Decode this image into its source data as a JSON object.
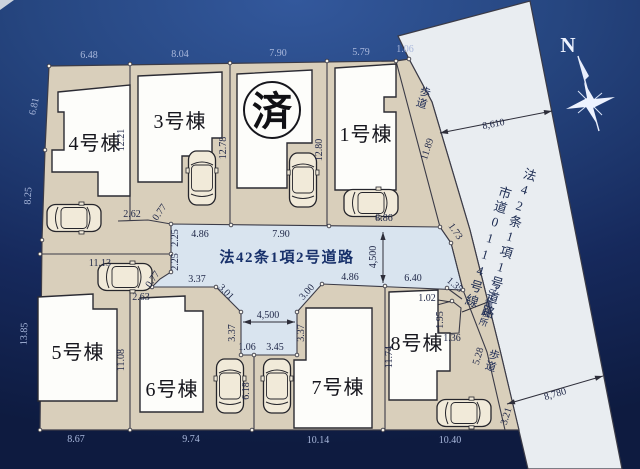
{
  "site_plan": {
    "lots": {
      "lot1": "1号棟",
      "lot3": "3号棟",
      "lot4": "4号棟",
      "lot5": "5号棟",
      "lot6": "6号棟",
      "lot7": "7号棟",
      "lot8": "8号棟",
      "lot2_sold_mark": "済"
    },
    "roads": {
      "middle_road": "法42条1項2号道路",
      "right_road_law": "法42条1項1号道路",
      "right_road_name": "市道0114号線"
    },
    "labels": {
      "sidewalk_upper": "歩道",
      "sidewalk_lower": "歩道",
      "garbage_station": "ゴミ集積所",
      "compass_north": "N"
    },
    "dims": {
      "top_lot4": "6.48",
      "top_lot3": "8.04",
      "top_lot2": "7.90",
      "top_lot1": "5.79",
      "top_corner": "1.06",
      "left_upper": "6.81",
      "left_middle": "8.25",
      "left_lower": "13.85",
      "bottom_lot5": "8.67",
      "bottom_lot6": "9.74",
      "bottom_lot7": "10.14",
      "bottom_lot8": "10.40",
      "b_lot4_lot3": "12.21",
      "b_lot3_lot2": "12.78",
      "b_lot2_lot1": "12.80",
      "b_lot5_lot6": "11.08",
      "b_lot7_lot8": "11.74",
      "lot5_north": "11.13",
      "lot67_parking": "6.18",
      "road_top_w": "4.86",
      "road_top_e": "7.90",
      "lot1_south": "8.86",
      "lot1_se_diag": "1.73",
      "road_e_width": "4,500",
      "step_a": "2.62",
      "step_b": "0.77",
      "step_c": "2.25",
      "step_d": "2.25",
      "step_e": "0.77",
      "step_f": "2.63",
      "lot6_north": "3.37",
      "stub_diag_w": "3.01",
      "stub_diag_e": "3.00",
      "stub_w": "3.37",
      "stub_e": "3.37",
      "stub_width": "4,500",
      "stub_s_w": "1.06",
      "stub_s_e": "3.45",
      "lot7_north": "4.86",
      "lot8_north": "6.40",
      "c8_diag": "1.35",
      "gb_n": "1.02",
      "gb_w": "1.95",
      "gb_s": "1.36",
      "sw_lot1": "11.89",
      "sw_lot8": "5.28",
      "sw_end": "3.21",
      "road_w_n": "8,610",
      "road_w_s": "8,780"
    },
    "colors": {
      "background_navy": "#16295c",
      "parcel_beige": "#d9cfbb",
      "main_road_white": "#e9edf1",
      "middle_road_blue": "#d9e4ef",
      "building_white": "#fdfdfa",
      "outside_dim_text": "#a9b8dc",
      "inside_dim_text": "#1e2647"
    }
  }
}
